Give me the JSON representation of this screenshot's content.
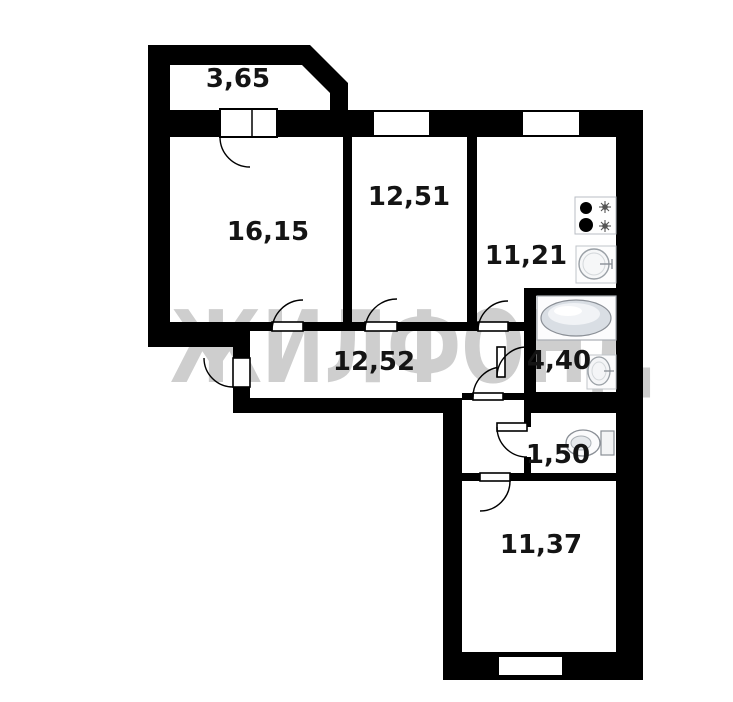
{
  "watermark": {
    "text": "ЖИЛФОНД",
    "color": "#9e9e9e"
  },
  "rooms": [
    {
      "id": "balcony",
      "area_label": "3,65"
    },
    {
      "id": "room-16",
      "area_label": "16,15"
    },
    {
      "id": "room-12",
      "area_label": "12,51"
    },
    {
      "id": "kitchen",
      "area_label": "11,21"
    },
    {
      "id": "hallway",
      "area_label": "12,52"
    },
    {
      "id": "bathroom",
      "area_label": "4,40"
    },
    {
      "id": "wc",
      "area_label": "1,50"
    },
    {
      "id": "room-11",
      "area_label": "11,37"
    }
  ],
  "fixtures": [
    {
      "name": "stove"
    },
    {
      "name": "kitchen-sink"
    },
    {
      "name": "bathtub"
    },
    {
      "name": "wash-basin"
    },
    {
      "name": "toilet"
    }
  ],
  "colors": {
    "wall": "#000000",
    "background": "#ffffff",
    "label": "#141414"
  }
}
